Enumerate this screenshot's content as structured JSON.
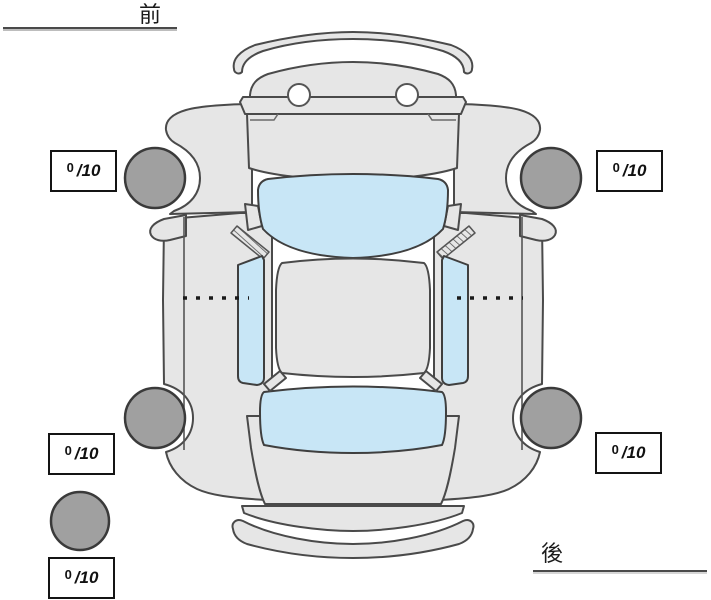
{
  "diagram": {
    "front_label": "前",
    "rear_label": "後",
    "ratings": {
      "front_left": {
        "value": "0",
        "max": "/10"
      },
      "front_right": {
        "value": "0",
        "max": "/10"
      },
      "rear_left": {
        "value": "0",
        "max": "/10"
      },
      "rear_right": {
        "value": "0",
        "max": "/10"
      },
      "spare": {
        "value": "0",
        "max": "/10"
      }
    },
    "colors": {
      "background": "#ffffff",
      "body": "#e6e6e6",
      "outline": "#4a4a4a",
      "window": "#c8e6f6",
      "tire": "#a0a0a0"
    }
  }
}
